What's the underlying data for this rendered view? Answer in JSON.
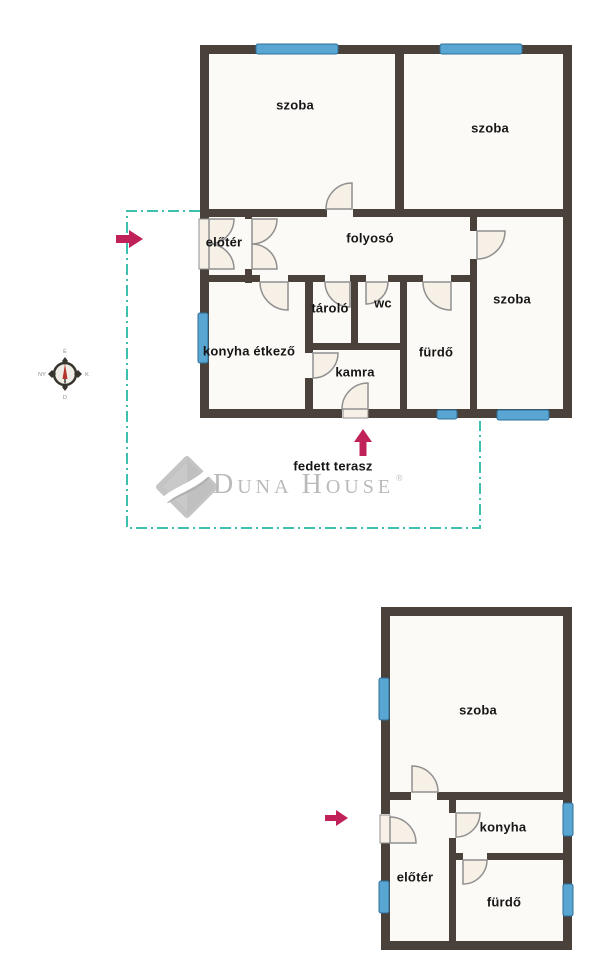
{
  "meta": {
    "type": "real-estate floor plan",
    "brand": "Duna House"
  },
  "colors": {
    "wall": "#49413a",
    "window_fill": "#5aa6d2",
    "window_border": "#2d6f99",
    "door_fill": "#f6f0e6",
    "door_stroke": "#909090",
    "room_fill": "#fcfaf6",
    "plot_boundary": "#3ec0ae",
    "arrow": "#c02158",
    "label_text": "#161616",
    "logo_gray": "#bababa"
  },
  "logo": {
    "d": "D",
    "una": "UNA",
    "h": "H",
    "ouse": "OUSE",
    "reg": "®",
    "full_text": "DUNA HOUSE®"
  },
  "compass": {
    "north_label": "É",
    "east_label": "K",
    "south_label": "D",
    "west_label": "NY"
  },
  "main_plan": {
    "name": "main building",
    "rooms": [
      {
        "label": "szoba"
      },
      {
        "label": "szoba"
      },
      {
        "label": "előtér"
      },
      {
        "label": "folyosó"
      },
      {
        "label": "szoba"
      },
      {
        "label": "tároló"
      },
      {
        "label": "wc"
      },
      {
        "label": "konyha étkező"
      },
      {
        "label": "kamra"
      },
      {
        "label": "fürdő"
      }
    ],
    "outside_label": "fedett terasz"
  },
  "secondary_plan": {
    "name": "secondary building",
    "rooms": [
      {
        "label": "szoba"
      },
      {
        "label": "konyha"
      },
      {
        "label": "előtér"
      },
      {
        "label": "fürdő"
      }
    ]
  }
}
